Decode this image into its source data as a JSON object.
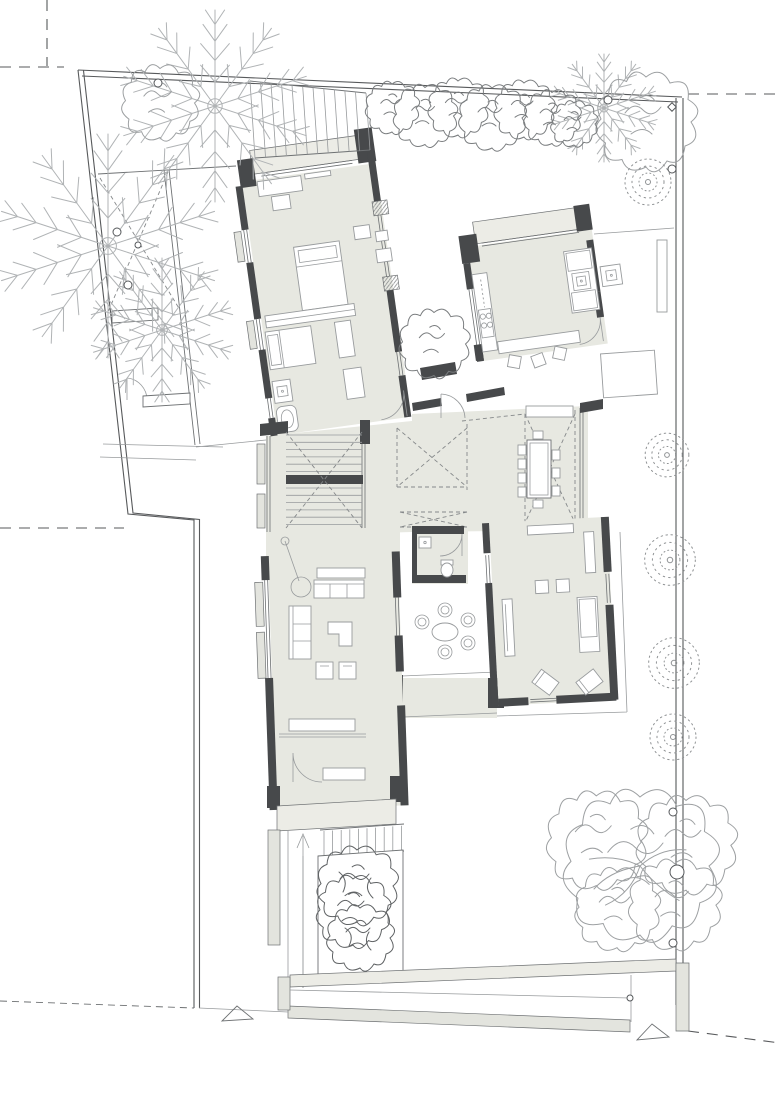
{
  "colors": {
    "wall": "#47494b",
    "floor": "#e7e8e1",
    "terrace": "#ecece6",
    "sill": "#e3e4de",
    "line": "#6e7173",
    "thin": "#989b9d",
    "dash": "#85888a",
    "boundary": "#57595b",
    "tree": "#b0b3b5",
    "canopy": "#9da0a2",
    "hedge": "#7a7d7f",
    "shrub": "#5f6264",
    "stipple": "#8f9294",
    "white": "#ffffff"
  },
  "garden": {
    "trees": [
      {
        "type": "fern",
        "x": 215,
        "y": 106,
        "s": 2.4,
        "tone": "tree"
      },
      {
        "type": "fern",
        "x": 108,
        "y": 246,
        "s": 2.8,
        "tone": "tree"
      },
      {
        "type": "fern",
        "x": 162,
        "y": 330,
        "s": 1.8,
        "tone": "tree"
      },
      {
        "type": "fern",
        "x": 604,
        "y": 108,
        "s": 1.35,
        "tone": "tree"
      },
      {
        "type": "blob",
        "x": 160,
        "y": 103,
        "s": 1.15,
        "tone": "canopy"
      },
      {
        "type": "blob",
        "x": 646,
        "y": 122,
        "s": 1.5,
        "tone": "canopy"
      },
      {
        "type": "blob",
        "x": 434,
        "y": 344,
        "s": 1.05,
        "tone": "hedge"
      },
      {
        "type": "bigtree",
        "x": 640,
        "y": 866,
        "s": 1.15,
        "tone": "canopy"
      },
      {
        "type": "stipple",
        "x": 648,
        "y": 182,
        "s": 1.0,
        "tone": "stipple"
      },
      {
        "type": "stipple",
        "x": 667,
        "y": 455,
        "s": 0.95,
        "tone": "stipple"
      },
      {
        "type": "stipple",
        "x": 670,
        "y": 560,
        "s": 1.1,
        "tone": "stipple"
      },
      {
        "type": "stipple",
        "x": 674,
        "y": 663,
        "s": 1.1,
        "tone": "stipple"
      },
      {
        "type": "stipple",
        "x": 673,
        "y": 737,
        "s": 1.0,
        "tone": "stipple"
      },
      {
        "type": "shrub",
        "x": 357,
        "y": 912,
        "s": 1.0,
        "tone": "shrub"
      }
    ],
    "hedge": [
      {
        "x": 392,
        "y": 108,
        "s": 0.8
      },
      {
        "x": 425,
        "y": 116,
        "s": 0.95
      },
      {
        "x": 458,
        "y": 108,
        "s": 0.9
      },
      {
        "x": 492,
        "y": 118,
        "s": 1.0
      },
      {
        "x": 524,
        "y": 110,
        "s": 0.9
      },
      {
        "x": 552,
        "y": 118,
        "s": 0.85
      },
      {
        "x": 574,
        "y": 124,
        "s": 0.7
      }
    ]
  },
  "markers": {
    "circles": [
      {
        "x": 158,
        "y": 83,
        "r": 4
      },
      {
        "x": 608,
        "y": 100,
        "r": 4
      },
      {
        "x": 672,
        "y": 169,
        "r": 4
      },
      {
        "x": 117,
        "y": 232,
        "r": 4
      },
      {
        "x": 138,
        "y": 245,
        "r": 3
      },
      {
        "x": 128,
        "y": 285,
        "r": 4
      },
      {
        "x": 673,
        "y": 812,
        "r": 4
      },
      {
        "x": 677,
        "y": 872,
        "r": 7
      },
      {
        "x": 673,
        "y": 943,
        "r": 4
      },
      {
        "x": 630,
        "y": 998,
        "r": 3
      }
    ],
    "diamonds": [
      {
        "x": 672,
        "y": 107,
        "r": 3
      }
    ]
  }
}
